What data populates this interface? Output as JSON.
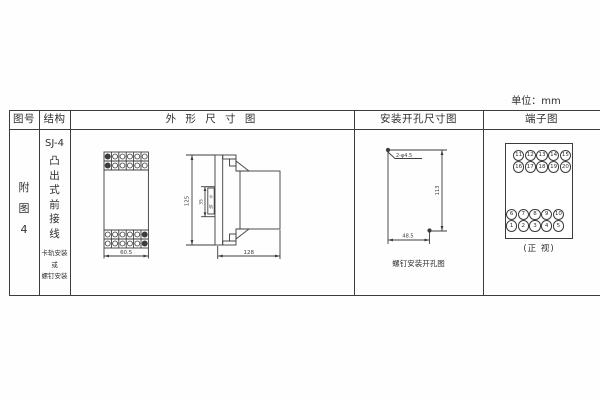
{
  "unit_label": "单位：mm",
  "headers": {
    "fig_no": "图号",
    "structure": "结构",
    "outline": "外 形 尺 寸 图",
    "mounting": "安装开孔尺寸图",
    "terminal": "端子图"
  },
  "fig_cell": {
    "chars": [
      "附",
      "图",
      "4"
    ]
  },
  "structure_cell": {
    "model": "SJ-4",
    "type_chars": [
      "凸",
      "出",
      "式",
      "前",
      "接",
      "线"
    ],
    "mount_lines": [
      "卡轨安装",
      "或",
      "螺钉安装"
    ]
  },
  "outline": {
    "front_width": "60.5",
    "side_height": "125",
    "inner_height": "35",
    "rail_chars": [
      "卡",
      "轨"
    ],
    "depth": "128"
  },
  "mounting": {
    "hole_label": "2-φ4.5",
    "v_dim": "113",
    "h_dim": "48.5",
    "caption": "螺钉安装开孔图"
  },
  "terminal": {
    "top_rows": [
      [
        "11",
        "12",
        "13",
        "14",
        "15"
      ],
      [
        "16",
        "17",
        "18",
        "19",
        "20"
      ]
    ],
    "bottom_rows": [
      [
        "6",
        "7",
        "8",
        "9",
        "10"
      ],
      [
        "1",
        "2",
        "3",
        "4",
        "5"
      ]
    ],
    "caption": "(正 视)"
  }
}
